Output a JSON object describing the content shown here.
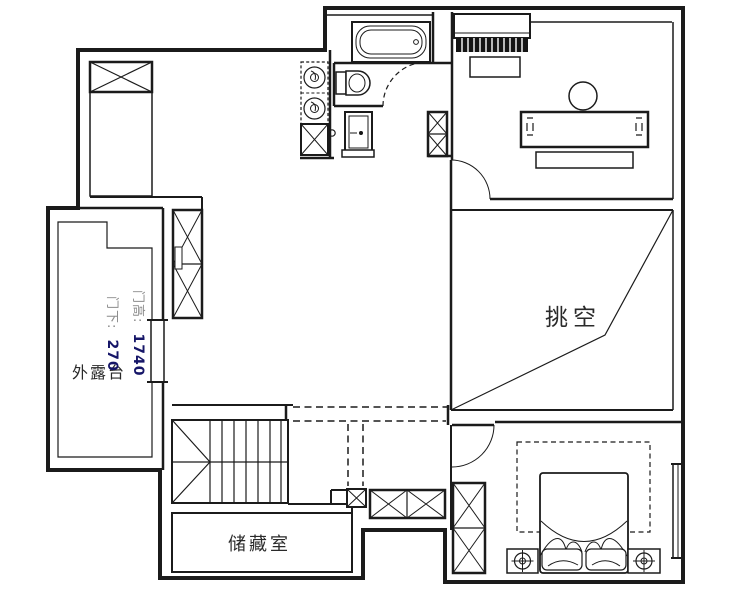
{
  "title": "floor-plan",
  "labels": {
    "void_area": "挑空",
    "storage_room": "储藏室",
    "terrace": "外露台",
    "door_height_label": "门高:",
    "door_height_value": "1740",
    "door_under_label": "门下:",
    "door_under_value": "270"
  },
  "colors": {
    "wall": "#1b1b1b",
    "background": "#ffffff",
    "annotation_gray": "#8c8c8c",
    "annotation_bold": "#161668",
    "label_text": "#2a2a2a"
  }
}
